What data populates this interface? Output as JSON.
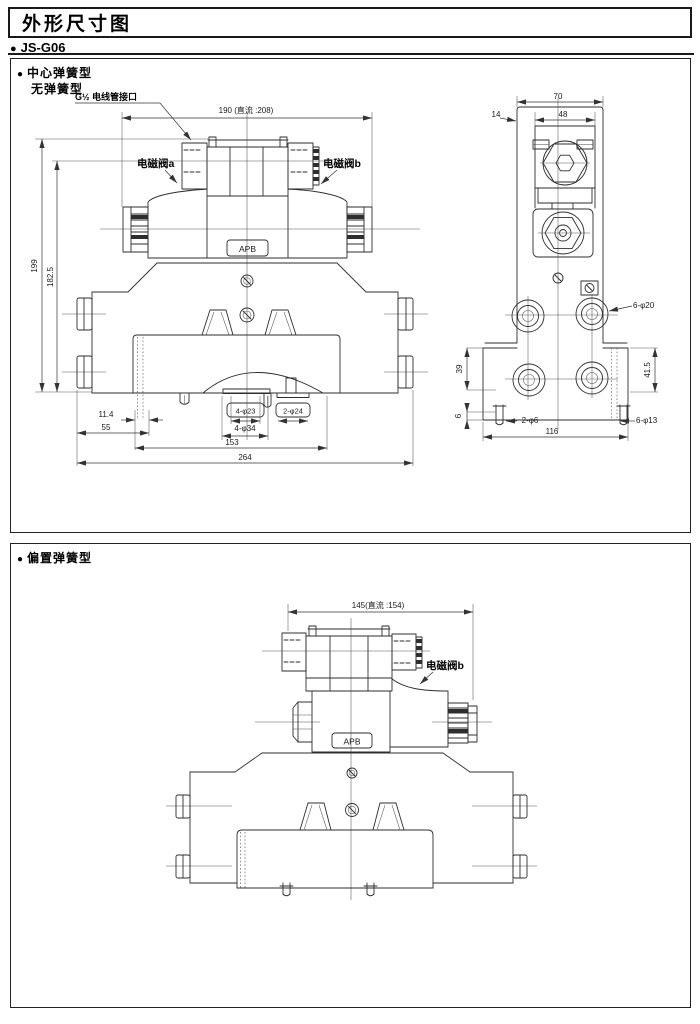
{
  "page": {
    "title": "外形尺寸图",
    "bullet": "●",
    "model": "JS-G06"
  },
  "section1": {
    "type1": "中心弹簧型",
    "type2": "无弹簧型",
    "front": {
      "conduit": "G½ 电线管接口",
      "dim_width": "190 (直流 :208)",
      "solenoid_a": "电磁阀a",
      "solenoid_b": "电磁阀b",
      "port_label": "APB",
      "dim_h1": "199",
      "dim_h2": "182.5",
      "dim_a": "11.4",
      "dim_b": "55",
      "dim_c": "4-φ23",
      "dim_d": "2-φ24",
      "dim_e": "4-φ34",
      "dim_f": "153",
      "dim_g": "264"
    },
    "side": {
      "dim_w1": "70",
      "dim_w2": "48",
      "dim_w3": "14",
      "dim_holes1": "6-φ20",
      "dim_v1": "39",
      "dim_v2": "41.5",
      "dim_v3": "6",
      "dim_holes2": "2-φ6",
      "dim_w4": "116",
      "dim_holes3": "6-φ13"
    }
  },
  "section2": {
    "type": "偏置弹簧型",
    "dim_width": "145(直流 :154)",
    "solenoid_b": "电磁阀b",
    "port_label": "APB"
  }
}
